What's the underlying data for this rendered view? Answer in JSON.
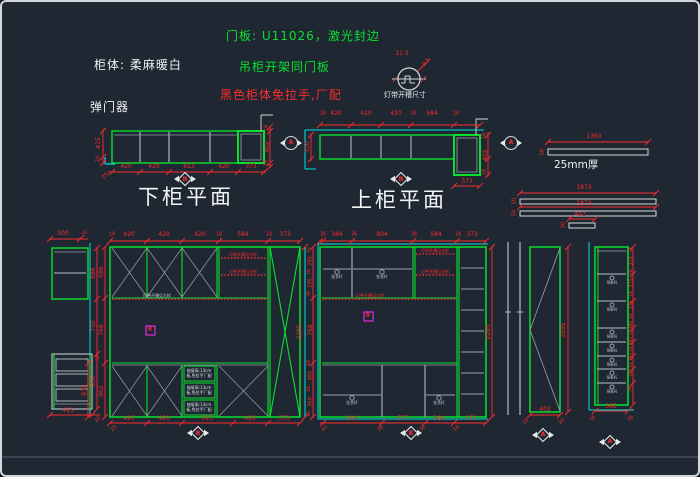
{
  "notes": {
    "door_panel": "门板: U11026，激光封边",
    "cabinet_body": "柜体: 柔麻暖白",
    "hanging_note": "吊柜开架同门板",
    "handle_note": "黑色柜体免拉手,厂配",
    "damper": "弹门器",
    "light_symbol_label": "灯带开槽尺寸",
    "thickness_label": "25mm厚"
  },
  "titles": {
    "lower_plan": "下柜平面",
    "upper_plan": "上柜平面"
  },
  "markers": {
    "section_a": "A",
    "section_b": "B"
  },
  "colors": {
    "background": "#1f2733",
    "cabinet_green": "#0ae02e",
    "dimension_red": "#fb2c2c",
    "wall_cyan": "#00e5e5",
    "line_white": "#d6dade",
    "shelf_gray": "#9aa2ac",
    "highlight_magenta": "#e02ce0",
    "text_white": "#eef1f4"
  },
  "views": {
    "lower_plan": {
      "bottom_dims": [
        420,
        420,
        613,
        420,
        373
      ],
      "left_dims": [
        415,
        20
      ],
      "right_dims": [
        18,
        402,
        18
      ],
      "corner_dim": 25
    },
    "upper_plan": {
      "top_dims": [
        18,
        420,
        420,
        420,
        18,
        584,
        18
      ],
      "left_dims": [
        320
      ],
      "right_dims": [
        18,
        402,
        18
      ],
      "bottom_dim": 373
    },
    "panels": {
      "bar1": {
        "length": 1360,
        "width": 50
      },
      "bar2": {
        "length": 1873,
        "width": 50
      },
      "bar3": {
        "length": 1873,
        "width": 50
      },
      "bar4": {
        "length": 402,
        "width": 50
      }
    },
    "left_column": {
      "top_dims": [
        300,
        20
      ],
      "right_dims": [
        686,
        750,
        850
      ],
      "bottom_dims": [
        415,
        20
      ]
    },
    "elevation_1": {
      "top_dims": [
        18,
        420,
        420,
        420,
        18,
        584,
        18,
        373
      ],
      "left_dims": [
        686,
        768,
        30,
        802,
        832
      ],
      "right_dim": 2285,
      "bottom_dims": [
        420,
        420,
        613,
        420,
        373,
        25
      ]
    },
    "elevation_2": {
      "top_dims": [
        36,
        384,
        36,
        804,
        36,
        584,
        18,
        373
      ],
      "left_dims": [
        43,
        295,
        18,
        295,
        36,
        768,
        18,
        400,
        18,
        360,
        36
      ],
      "right_dim": 2285,
      "bottom_dims": [
        804,
        577,
        384,
        373
      ],
      "bottom_angled": [
        43,
        36,
        36,
        18
      ]
    },
    "door_panel": {
      "height": 2285,
      "width": 402,
      "angled": [
        18,
        20
      ]
    },
    "shelf_column": {
      "right_dims": [
        18,
        374,
        18,
        375,
        18,
        375,
        18,
        180,
        18,
        180,
        18,
        180,
        18,
        180,
        68
      ],
      "bottom_dims": [
        366,
        36,
        36
      ]
    }
  },
  "annotations": [
    [
      "11.5",
      400,
      52,
      "r",
      0,
      6
    ],
    [
      "9.5",
      425,
      61,
      "r",
      -50,
      5.5
    ],
    [
      "420",
      124,
      165,
      "r",
      0,
      6
    ],
    [
      "420",
      152,
      165,
      "r",
      0,
      6
    ],
    [
      "613",
      187,
      165,
      "r",
      0,
      6
    ],
    [
      "420",
      222,
      165,
      "r",
      0,
      6
    ],
    [
      "373",
      249,
      165,
      "r",
      0,
      6
    ],
    [
      "25",
      104,
      175,
      "r",
      -45,
      5.5
    ],
    [
      "415",
      97,
      141,
      "r",
      -90,
      6
    ],
    [
      "20",
      97,
      157,
      "r",
      -90,
      5.5
    ],
    [
      "18",
      265,
      126,
      "r",
      -90,
      5
    ],
    [
      "402",
      266,
      145,
      "r",
      -90,
      6
    ],
    [
      "18",
      265,
      161,
      "r",
      -90,
      5
    ],
    [
      "B",
      183,
      177,
      "mk",
      0,
      6.5
    ],
    [
      "18",
      321,
      112,
      "r",
      0,
      5
    ],
    [
      "420",
      334,
      112,
      "r",
      0,
      6
    ],
    [
      "420",
      364,
      112,
      "r",
      0,
      6
    ],
    [
      "420",
      394,
      112,
      "r",
      0,
      6
    ],
    [
      "18",
      411,
      112,
      "r",
      0,
      5
    ],
    [
      "584",
      430,
      112,
      "r",
      0,
      6
    ],
    [
      "18",
      454,
      112,
      "r",
      0,
      5
    ],
    [
      "320",
      306,
      145,
      "r",
      -90,
      6
    ],
    [
      "18",
      483,
      134,
      "r",
      -90,
      5
    ],
    [
      "402",
      484,
      153,
      "r",
      -90,
      6
    ],
    [
      "18",
      483,
      170,
      "r",
      -90,
      5
    ],
    [
      "373",
      465,
      180,
      "r",
      0,
      6
    ],
    [
      "B",
      399,
      177,
      "mk",
      0,
      6.5
    ],
    [
      "A",
      289,
      141,
      "mk",
      0,
      6
    ],
    [
      "A",
      509,
      141,
      "mk",
      0,
      6
    ],
    [
      "1360",
      592,
      135,
      "r",
      0,
      6
    ],
    [
      "50",
      541,
      150,
      "r",
      -90,
      5
    ],
    [
      "1873",
      582,
      186,
      "r",
      0,
      6
    ],
    [
      "50",
      513,
      199,
      "r",
      -90,
      5
    ],
    [
      "1873",
      582,
      202,
      "r",
      0,
      6
    ],
    [
      "50",
      513,
      211,
      "r",
      -90,
      5
    ],
    [
      "402",
      578,
      213,
      "r",
      0,
      6
    ],
    [
      "50",
      562,
      223,
      "r",
      -90,
      5
    ],
    [
      "300",
      61,
      232,
      "r",
      0,
      6
    ],
    [
      "20",
      83,
      232,
      "r",
      -45,
      5
    ],
    [
      "686",
      92,
      271,
      "r",
      -90,
      6
    ],
    [
      "750",
      92,
      324,
      "r",
      -90,
      6
    ],
    [
      "850",
      92,
      379,
      "r",
      -90,
      6
    ],
    [
      "415",
      66,
      409,
      "r",
      0,
      6
    ],
    [
      "20",
      96,
      418,
      "r",
      -45,
      5
    ],
    [
      "18",
      110,
      233,
      "r",
      0,
      5
    ],
    [
      "420",
      127,
      233,
      "r",
      0,
      6
    ],
    [
      "420",
      162,
      233,
      "r",
      0,
      6
    ],
    [
      "420",
      198,
      233,
      "r",
      0,
      6
    ],
    [
      "18",
      217,
      233,
      "r",
      0,
      5
    ],
    [
      "584",
      241,
      233,
      "r",
      0,
      6
    ],
    [
      "18",
      267,
      233,
      "r",
      0,
      5
    ],
    [
      "373",
      283,
      233,
      "r",
      0,
      6
    ],
    [
      "686",
      100,
      270,
      "r",
      -90,
      6
    ],
    [
      "768",
      100,
      328,
      "r",
      -90,
      6
    ],
    [
      "30",
      97,
      356,
      "r",
      -90,
      4.5
    ],
    [
      "802",
      100,
      389,
      "r",
      -90,
      6
    ],
    [
      "832",
      83,
      388,
      "r",
      -90,
      6
    ],
    [
      "2285",
      298,
      330,
      "r",
      -90,
      6
    ],
    [
      "420",
      127,
      417,
      "r",
      0,
      6
    ],
    [
      "420",
      162,
      417,
      "r",
      0,
      6
    ],
    [
      "613",
      205,
      417,
      "r",
      0,
      6
    ],
    [
      "420",
      248,
      417,
      "r",
      0,
      6
    ],
    [
      "373",
      282,
      417,
      "r",
      0,
      6
    ],
    [
      "25",
      112,
      427,
      "r",
      -45,
      5
    ],
    [
      "B",
      196,
      431,
      "mk",
      0,
      6.5
    ],
    [
      "B",
      148,
      328,
      "mg",
      0,
      5.5
    ],
    [
      "灯带开槽见大样",
      241,
      253,
      "t",
      0,
      4
    ],
    [
      "灯带开槽见大样",
      241,
      270,
      "t",
      0,
      4
    ],
    [
      "灯带开槽见大样",
      155,
      294,
      "y",
      0,
      4
    ],
    [
      "抽屉高:13cm",
      197,
      369,
      "w",
      0,
      4
    ],
    [
      "板,免拉手厂配",
      197,
      374,
      "w",
      0,
      4
    ],
    [
      "抽屉高:13cm",
      197,
      386,
      "w",
      0,
      4
    ],
    [
      "板,免拉手厂配",
      197,
      391,
      "w",
      0,
      4
    ],
    [
      "抽屉高:13cm",
      197,
      403,
      "w",
      0,
      4
    ],
    [
      "板,免拉手厂配",
      197,
      408,
      "w",
      0,
      4
    ],
    [
      "36",
      321,
      233,
      "r",
      0,
      5
    ],
    [
      "384",
      335,
      233,
      "r",
      0,
      6
    ],
    [
      "36",
      352,
      233,
      "r",
      0,
      5
    ],
    [
      "804",
      380,
      233,
      "r",
      0,
      6
    ],
    [
      "36",
      412,
      233,
      "r",
      0,
      5
    ],
    [
      "584",
      434,
      233,
      "r",
      0,
      6
    ],
    [
      "18",
      456,
      233,
      "r",
      0,
      5
    ],
    [
      "373",
      470,
      233,
      "r",
      0,
      6
    ],
    [
      "43",
      308,
      248,
      "r",
      -90,
      4.5
    ],
    [
      "295",
      309,
      259,
      "r",
      -90,
      5
    ],
    [
      "18",
      308,
      270,
      "r",
      -90,
      4.5
    ],
    [
      "295",
      309,
      281,
      "r",
      -90,
      5
    ],
    [
      "36",
      308,
      292,
      "r",
      -90,
      4.5
    ],
    [
      "768",
      309,
      328,
      "r",
      -90,
      6
    ],
    [
      "18",
      308,
      361,
      "r",
      -90,
      4.5
    ],
    [
      "400",
      309,
      374,
      "r",
      -90,
      5
    ],
    [
      "18",
      308,
      387,
      "r",
      -90,
      4.5
    ],
    [
      "360",
      309,
      400,
      "r",
      -90,
      5
    ],
    [
      "36",
      308,
      412,
      "r",
      -90,
      4.5
    ],
    [
      "2285",
      487,
      330,
      "r",
      -90,
      6
    ],
    [
      "804",
      350,
      417,
      "r",
      0,
      6
    ],
    [
      "577",
      401,
      417,
      "r",
      0,
      6
    ],
    [
      "384",
      437,
      417,
      "r",
      0,
      6
    ],
    [
      "373",
      469,
      417,
      "r",
      0,
      6
    ],
    [
      "43",
      323,
      427,
      "r",
      -45,
      5
    ],
    [
      "36",
      379,
      427,
      "r",
      -45,
      5
    ],
    [
      "36",
      421,
      427,
      "r",
      -45,
      5
    ],
    [
      "18",
      455,
      427,
      "r",
      -45,
      5
    ],
    [
      "B",
      409,
      431,
      "mk",
      0,
      6.5
    ],
    [
      "B",
      366,
      314,
      "mg",
      0,
      5.5
    ],
    [
      "灯带开槽见大样",
      433,
      249,
      "t",
      0,
      4
    ],
    [
      "灯带开槽见大样",
      433,
      270,
      "t",
      0,
      4
    ],
    [
      "灯带开槽见大样",
      368,
      294,
      "t",
      0,
      4
    ],
    [
      "挂衣杆",
      335,
      275,
      "y",
      0,
      3.8
    ],
    [
      "挂衣杆",
      380,
      275,
      "y",
      0,
      3.8
    ],
    [
      "挂衣杆",
      350,
      401,
      "y",
      0,
      3.8
    ],
    [
      "挂衣杆",
      437,
      401,
      "y",
      0,
      3.8
    ],
    [
      "2285",
      562,
      328,
      "r",
      -90,
      6
    ],
    [
      "402",
      543,
      408,
      "r",
      0,
      6
    ],
    [
      "18",
      524,
      420,
      "r",
      -45,
      5
    ],
    [
      "20",
      560,
      420,
      "r",
      -45,
      5
    ],
    [
      "A",
      541,
      433,
      "mk",
      0,
      6
    ],
    [
      "18",
      629,
      248,
      "r",
      -90,
      4.2
    ],
    [
      "374",
      630,
      259,
      "r",
      -90,
      5
    ],
    [
      "18",
      629,
      270,
      "r",
      -90,
      4.2
    ],
    [
      "375",
      630,
      281,
      "r",
      -90,
      5
    ],
    [
      "18",
      629,
      292,
      "r",
      -90,
      4.2
    ],
    [
      "375",
      630,
      303,
      "r",
      -90,
      5
    ],
    [
      "18",
      629,
      314,
      "r",
      -90,
      4.2
    ],
    [
      "180",
      630,
      323,
      "r",
      -90,
      4.5
    ],
    [
      "18",
      629,
      331,
      "r",
      -90,
      4.2
    ],
    [
      "180",
      630,
      339,
      "r",
      -90,
      4.5
    ],
    [
      "18",
      629,
      347,
      "r",
      -90,
      4.2
    ],
    [
      "180",
      630,
      355,
      "r",
      -90,
      4.5
    ],
    [
      "18",
      629,
      363,
      "r",
      -90,
      4.2
    ],
    [
      "180",
      630,
      371,
      "r",
      -90,
      4.5
    ],
    [
      "68",
      629,
      386,
      "r",
      -90,
      4.5
    ],
    [
      "366",
      609,
      405,
      "r",
      0,
      6
    ],
    [
      "36",
      591,
      417,
      "r",
      -45,
      5
    ],
    [
      "36",
      629,
      417,
      "r",
      -45,
      5
    ],
    [
      "A",
      608,
      440,
      "mk",
      0,
      6
    ],
    [
      "层板托",
      610,
      281,
      "y",
      0,
      3.5
    ],
    [
      "层板托",
      610,
      308,
      "y",
      0,
      3.5
    ],
    [
      "层板托",
      610,
      335,
      "y",
      0,
      3.5
    ],
    [
      "层板托",
      610,
      349,
      "y",
      0,
      3.5
    ],
    [
      "层板托",
      610,
      363,
      "y",
      0,
      3.5
    ],
    [
      "层板托",
      610,
      376,
      "y",
      0,
      3.5
    ],
    [
      "层板托",
      610,
      390,
      "y",
      0,
      3.5
    ]
  ]
}
